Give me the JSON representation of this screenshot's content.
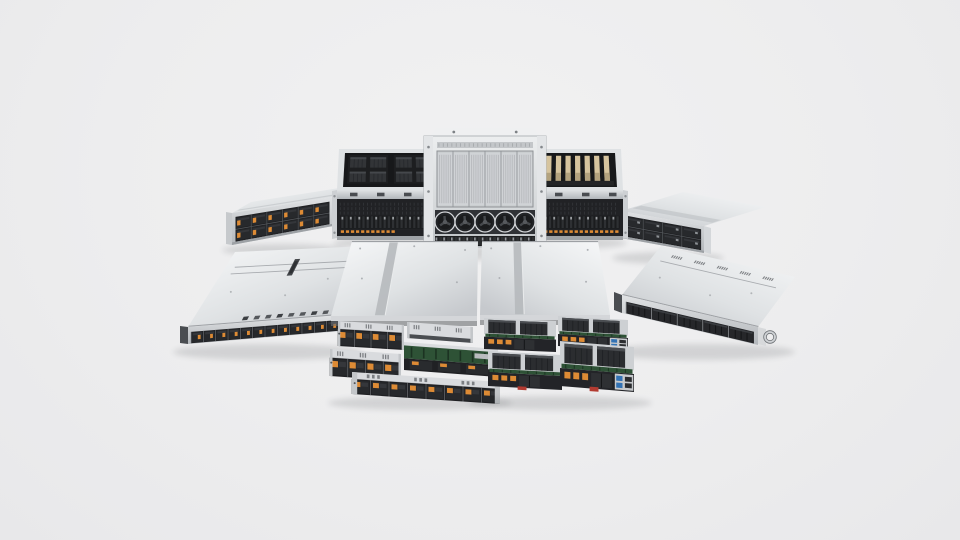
{
  "meta": {
    "description": "Product photo: lineup of silver rackmount servers with dark drive bays and orange latches",
    "background": "#ededee"
  },
  "palette": {
    "background": "#ededee",
    "silver_bright": "#f6f7f8",
    "silver": "#cfd2d5",
    "silver_deep": "#aab0b4",
    "dark_panel": "#1e1f21",
    "dark_mid": "#2b2d30",
    "accent_orange": "#dd8b35",
    "gold_card": "#d6c49e",
    "pcb_green": "#2e5236",
    "usb_blue": "#3272b4",
    "red_tab": "#b23b31"
  },
  "scene": {
    "servers": [
      {
        "id": "storage-2u-back-left",
        "kind": "storage2u",
        "grad": "L",
        "top": [
          [
            232,
            213
          ],
          [
            333,
            197
          ],
          [
            352,
            186
          ],
          [
            251,
            202
          ]
        ],
        "front": [
          [
            232,
            213
          ],
          [
            333,
            197
          ],
          [
            333,
            226
          ],
          [
            232,
            245
          ]
        ],
        "cols": 6,
        "accent": "orange",
        "earL": [
          [
            226,
            212
          ],
          [
            232,
            213
          ],
          [
            232,
            245
          ],
          [
            226,
            244
          ]
        ],
        "earR": [
          [
            333,
            196
          ],
          [
            339,
            195
          ],
          [
            339,
            224
          ],
          [
            333,
            225
          ]
        ],
        "shadow": [
          284,
          250,
          62,
          6
        ]
      },
      {
        "id": "gpu-4u-back-left",
        "kind": "gpu4u",
        "modules": "dark",
        "orange": "half",
        "outerTop": [
          [
            339,
            149
          ],
          [
            443,
            149
          ],
          [
            445,
            190
          ],
          [
            337,
            190
          ]
        ],
        "opening": [
          [
            345,
            153
          ],
          [
            437,
            153
          ],
          [
            439,
            187
          ],
          [
            343,
            187
          ]
        ],
        "mid": [
          [
            337,
            190
          ],
          [
            445,
            190
          ],
          [
            445,
            199
          ],
          [
            337,
            199
          ]
        ],
        "front": [
          [
            337,
            199
          ],
          [
            445,
            199
          ],
          [
            445,
            236
          ],
          [
            337,
            236
          ]
        ],
        "base": [
          [
            337,
            236
          ],
          [
            445,
            236
          ],
          [
            445,
            240
          ],
          [
            337,
            240
          ]
        ],
        "earL": [
          [
            332,
            191
          ],
          [
            337,
            190
          ],
          [
            337,
            238
          ],
          [
            332,
            239
          ]
        ],
        "earR": [
          [
            445,
            190
          ],
          [
            450,
            191
          ],
          [
            450,
            239
          ],
          [
            445,
            238
          ]
        ],
        "shadow": [
          391,
          243,
          58,
          6
        ]
      },
      {
        "id": "storage-2u-back-right",
        "kind": "storage2u",
        "grad": "R",
        "top": [
          [
            621,
            211
          ],
          [
            704,
            226
          ],
          [
            766,
            207
          ],
          [
            683,
            192
          ]
        ],
        "front": [
          [
            621,
            211
          ],
          [
            704,
            226
          ],
          [
            704,
            253
          ],
          [
            621,
            238
          ]
        ],
        "cols": 4,
        "accent": "specks",
        "earL": [
          [
            615,
            210
          ],
          [
            621,
            211
          ],
          [
            621,
            238
          ],
          [
            615,
            237
          ]
        ],
        "earR": [
          [
            704,
            226
          ],
          [
            711,
            228
          ],
          [
            711,
            254
          ],
          [
            704,
            252
          ]
        ],
        "shadow": [
          668,
          258,
          56,
          6
        ]
      },
      {
        "id": "gpu-4u-back-right",
        "kind": "gpu4u",
        "modules": "gold",
        "orange": "full",
        "outerTop": [
          [
            517,
            149
          ],
          [
            621,
            149
          ],
          [
            623,
            190
          ],
          [
            515,
            190
          ]
        ],
        "opening": [
          [
            523,
            153
          ],
          [
            615,
            153
          ],
          [
            617,
            187
          ],
          [
            521,
            187
          ]
        ],
        "mid": [
          [
            515,
            190
          ],
          [
            623,
            190
          ],
          [
            623,
            199
          ],
          [
            515,
            199
          ]
        ],
        "front": [
          [
            515,
            199
          ],
          [
            623,
            199
          ],
          [
            623,
            236
          ],
          [
            515,
            236
          ]
        ],
        "base": [
          [
            515,
            236
          ],
          [
            623,
            236
          ],
          [
            623,
            240
          ],
          [
            515,
            240
          ]
        ],
        "earL": [
          [
            510,
            191
          ],
          [
            515,
            190
          ],
          [
            515,
            238
          ],
          [
            510,
            239
          ]
        ],
        "earR": [
          [
            623,
            190
          ],
          [
            628,
            191
          ],
          [
            628,
            239
          ],
          [
            623,
            238
          ]
        ],
        "shadow": [
          569,
          243,
          58,
          6
        ]
      },
      {
        "id": "gpu-8u-center",
        "kind": "gpu8u",
        "lip": [
          [
            436,
            128
          ],
          [
            534,
            128
          ],
          [
            540,
            136
          ],
          [
            430,
            136
          ]
        ],
        "body": [
          [
            424,
            136
          ],
          [
            546,
            136
          ],
          [
            546,
            247
          ],
          [
            424,
            247
          ]
        ],
        "vent": [
          [
            437,
            142
          ],
          [
            533,
            142
          ],
          [
            533,
            148
          ],
          [
            437,
            148
          ]
        ],
        "grille": [
          [
            437,
            151
          ],
          [
            533,
            151
          ],
          [
            533,
            207
          ],
          [
            437,
            207
          ]
        ],
        "fanRow": [
          [
            435,
            210
          ],
          [
            535,
            210
          ],
          [
            535,
            234
          ],
          [
            435,
            234
          ]
        ],
        "fans": 5,
        "driveRow": [
          [
            435,
            236
          ],
          [
            535,
            236
          ],
          [
            535,
            246
          ],
          [
            435,
            246
          ]
        ],
        "earL": [
          [
            424,
            136
          ],
          [
            433,
            136
          ],
          [
            433,
            247
          ],
          [
            424,
            247
          ]
        ],
        "earR": [
          [
            537,
            136
          ],
          [
            546,
            136
          ],
          [
            546,
            247
          ],
          [
            537,
            247
          ]
        ],
        "shadow": [
          485,
          253,
          66,
          7
        ]
      },
      {
        "id": "server-1u-mid-left",
        "kind": "oneu",
        "grad": "L",
        "style": "orange-12",
        "bays": 12,
        "top": [
          [
            188,
            327
          ],
          [
            342,
            315
          ],
          [
            368,
            246
          ],
          [
            235,
            252
          ]
        ],
        "front": [
          [
            188,
            327
          ],
          [
            342,
            315
          ],
          [
            342,
            331
          ],
          [
            188,
            344
          ]
        ],
        "backDashes": 8,
        "lines": [
          0.7,
          0.79
        ],
        "slot": true,
        "earL": [
          [
            180,
            326
          ],
          [
            188,
            327
          ],
          [
            188,
            344
          ],
          [
            180,
            343
          ]
        ],
        "earR": [
          [
            342,
            313
          ],
          [
            351,
            312
          ],
          [
            351,
            328
          ],
          [
            342,
            330
          ]
        ],
        "shadow": [
          268,
          352,
          95,
          8
        ]
      },
      {
        "id": "server-1u-mid-right",
        "kind": "oneu",
        "grad": "R",
        "style": "mesh-5",
        "bays": 5,
        "top": [
          [
            622,
            295
          ],
          [
            758,
            327
          ],
          [
            795,
            277
          ],
          [
            661,
            246
          ]
        ],
        "front": [
          [
            622,
            295
          ],
          [
            758,
            327
          ],
          [
            758,
            345
          ],
          [
            622,
            313
          ]
        ],
        "frontDashGroups": 5,
        "lines": [
          0.74
        ],
        "earL": [
          [
            614,
            292
          ],
          [
            622,
            295
          ],
          [
            622,
            313
          ],
          [
            614,
            310
          ]
        ],
        "earR": [
          [
            758,
            327
          ],
          [
            766,
            329
          ],
          [
            766,
            346
          ],
          [
            758,
            344
          ]
        ],
        "handle": [
          770,
          337,
          5
        ],
        "shadow": [
          700,
          352,
          95,
          8
        ]
      },
      {
        "id": "twin-chassis-left",
        "kind": "twin",
        "grad": "L",
        "stripe": [
          0.3,
          0.37
        ],
        "top": [
          [
            352,
            241
          ],
          [
            478,
            241
          ],
          [
            477,
            316
          ],
          [
            331,
            316
          ]
        ],
        "lipQ": [
          [
            331,
            316
          ],
          [
            477,
            316
          ],
          [
            477,
            321
          ],
          [
            331,
            321
          ]
        ],
        "gapQ": [
          [
            331,
            321
          ],
          [
            477,
            321
          ],
          [
            477,
            326
          ],
          [
            331,
            326
          ]
        ],
        "trays": [
          {
            "style": "bays",
            "bays": 4,
            "quad": [
              [
                338,
                321
              ],
              [
                404,
                325
              ],
              [
                404,
                350
              ],
              [
                338,
                346
              ]
            ]
          },
          {
            "style": "vent",
            "quad": [
              [
                407,
                322
              ],
              [
                473,
                327
              ],
              [
                473,
                343
              ],
              [
                407,
                338
              ]
            ]
          },
          {
            "style": "pcb",
            "quad": [
              [
                404,
                342
              ],
              [
                498,
                349
              ],
              [
                498,
                377
              ],
              [
                404,
                370
              ]
            ]
          },
          {
            "style": "bays",
            "bays": 4,
            "quad": [
              [
                330,
                349
              ],
              [
                401,
                354
              ],
              [
                401,
                381
              ],
              [
                330,
                376
              ]
            ]
          },
          {
            "style": "bays",
            "bays": 8,
            "quad": [
              [
                352,
                372
              ],
              [
                500,
                382
              ],
              [
                500,
                404
              ],
              [
                352,
                394
              ]
            ]
          }
        ],
        "shadow": [
          420,
          403,
          92,
          7
        ]
      },
      {
        "id": "twin-chassis-right",
        "kind": "twin",
        "grad": "R",
        "stripe": [
          0.27,
          0.34
        ],
        "top": [
          [
            482,
            241
          ],
          [
            598,
            241
          ],
          [
            610,
            315
          ],
          [
            480,
            315
          ]
        ],
        "lipQ": [
          [
            480,
            315
          ],
          [
            610,
            315
          ],
          [
            610,
            320
          ],
          [
            480,
            320
          ]
        ],
        "gapQ": [
          [
            480,
            320
          ],
          [
            610,
            320
          ],
          [
            610,
            325
          ],
          [
            480,
            325
          ]
        ],
        "trays": [
          {
            "style": "heatsink",
            "quad": [
              [
                484,
                318
              ],
              [
                556,
                321
              ],
              [
                556,
                352
              ],
              [
                484,
                349
              ]
            ]
          },
          {
            "style": "heatsink",
            "io": true,
            "quad": [
              [
                558,
                316
              ],
              [
                628,
                320
              ],
              [
                628,
                350
              ],
              [
                558,
                346
              ]
            ]
          },
          {
            "style": "heatsink",
            "red": true,
            "quad": [
              [
                488,
                351
              ],
              [
                562,
                355
              ],
              [
                562,
                390
              ],
              [
                488,
                386
              ]
            ]
          },
          {
            "style": "heatsink",
            "io": true,
            "red": true,
            "quad": [
              [
                560,
                341
              ],
              [
                634,
                347
              ],
              [
                634,
                392
              ],
              [
                560,
                386
              ]
            ]
          }
        ],
        "shadow": [
          560,
          403,
          92,
          7
        ]
      }
    ]
  }
}
